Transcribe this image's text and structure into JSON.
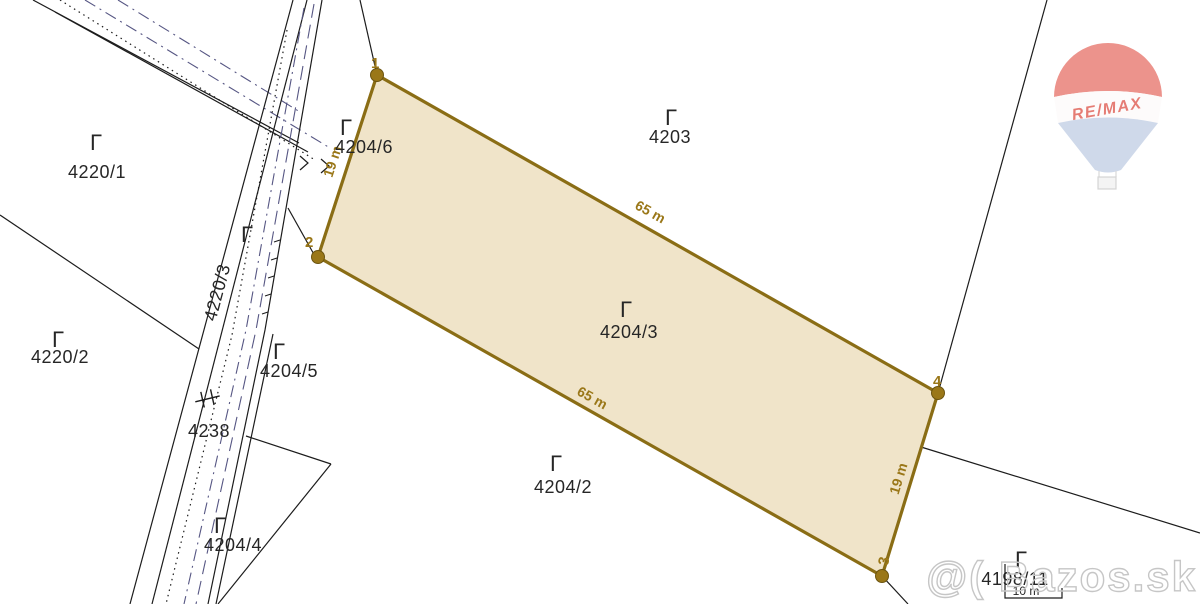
{
  "map": {
    "type": "cadastral-parcel-map",
    "region_labels": [
      {
        "label": "4220/1"
      },
      {
        "label": "4220/2"
      },
      {
        "label": "4220/3"
      },
      {
        "label": "4204/6"
      },
      {
        "label": "4203"
      },
      {
        "label": "4204/3"
      },
      {
        "label": "4204/5"
      },
      {
        "label": "4238"
      },
      {
        "label": "4204/4"
      },
      {
        "label": "4204/2"
      },
      {
        "label": "4198/11"
      }
    ],
    "land_use_symbol": "Γ",
    "highlight": {
      "parcel": "4204/3",
      "corners": [
        {
          "n": "1"
        },
        {
          "n": "2"
        },
        {
          "n": "3"
        },
        {
          "n": "4"
        }
      ],
      "dims": [
        {
          "text": "19 m"
        },
        {
          "text": "65 m"
        },
        {
          "text": "65 m"
        },
        {
          "text": "19 m"
        }
      ],
      "fill_color": "#f0e4c9",
      "border_color": "#8a6d15",
      "marker_color": "#9a7718",
      "label_color": "#9a7718"
    },
    "road_dash_color": "#565683",
    "boundary_color": "#1c1c1c",
    "scale": {
      "text": "10 m"
    }
  },
  "logo": {
    "text": "RE/MAX",
    "colors": {
      "dome": "#ec8e86",
      "cone": "#cdd7e9",
      "text": "#e4766d"
    }
  },
  "watermark": {
    "text": "@( Bazos.sk",
    "color": "#c6c6c6"
  }
}
